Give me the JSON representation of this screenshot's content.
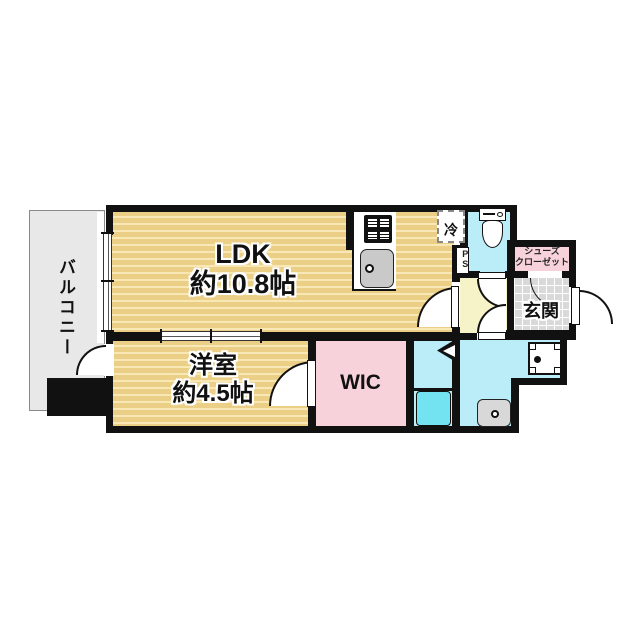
{
  "floorplan": {
    "title": "1LDK apartment floor plan",
    "rooms": {
      "balcony": {
        "label": "バルコニー"
      },
      "ldk": {
        "label": "LDK",
        "size": "約10.8帖"
      },
      "bedroom": {
        "label": "洋室",
        "size": "約4.5帖"
      },
      "wic": {
        "label": "WIC"
      },
      "genkan": {
        "label": "玄関"
      },
      "shoes_closet": {
        "label_line1": "シューズ",
        "label_line2": "クローゼット"
      },
      "fridge": {
        "label": "冷"
      },
      "pipe_space": {
        "label": "PS"
      }
    },
    "colors": {
      "wall": "#111111",
      "ldk_floor_base": "#eccf86",
      "ldk_floor_stripe": "#f7e8b5",
      "balcony": "#e8e8e8",
      "hallway": "#f7f3c8",
      "closet_pink": "#f8d2da",
      "wet_area_cyan": "#baedf7",
      "bathtub": "#74e3f1",
      "genkan_tile": "#d9d9d9"
    }
  }
}
